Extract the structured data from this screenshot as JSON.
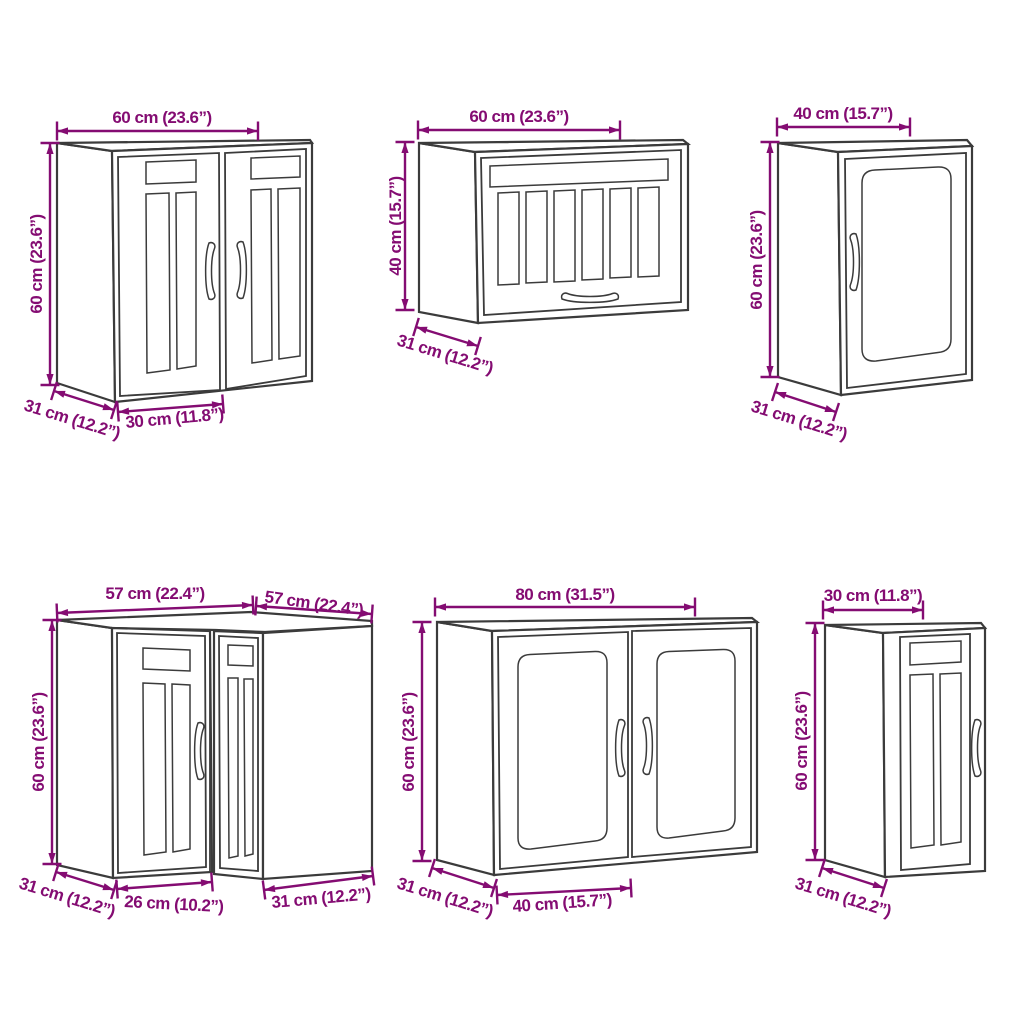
{
  "colors": {
    "accent": "#840C72",
    "line": "#3B3B3B",
    "background": "#FFFFFF"
  },
  "cabinets": [
    {
      "kind": "wall-cabinet-two-framed-doors",
      "position": "top-left",
      "width": "60 cm (23.6”)",
      "height": "60 cm (23.6”)",
      "depth": "31 cm (12.2”)",
      "door_width": "30 cm (11.8”)"
    },
    {
      "kind": "wall-cabinet-flip-up-slatted-door",
      "position": "top-middle",
      "width": "60 cm (23.6”)",
      "height": "40 cm (15.7”)",
      "depth": "31 cm (12.2”)"
    },
    {
      "kind": "wall-cabinet-glass-door",
      "position": "top-right",
      "width": "40 cm (15.7”)",
      "height": "60 cm (23.6”)",
      "depth": "31 cm (12.2”)"
    },
    {
      "kind": "corner-wall-cabinet",
      "position": "bottom-left",
      "width_left": "57 cm (22.4”)",
      "width_right": "57 cm (22.4”)",
      "height": "60 cm (23.6”)",
      "depth": "31 cm (12.2”)",
      "door_width": "26 cm (10.2”)",
      "side_width": "31 cm (12.2”)"
    },
    {
      "kind": "wall-cabinet-two-glass-doors",
      "position": "bottom-middle",
      "width": "80 cm (31.5”)",
      "height": "60 cm (23.6”)",
      "depth": "31 cm (12.2”)",
      "door_width": "40 cm (15.7”)"
    },
    {
      "kind": "narrow-wall-cabinet-framed-door",
      "position": "bottom-right",
      "width": "30 cm (11.8”)",
      "height": "60 cm (23.6”)",
      "depth": "31 cm (12.2”)"
    }
  ]
}
